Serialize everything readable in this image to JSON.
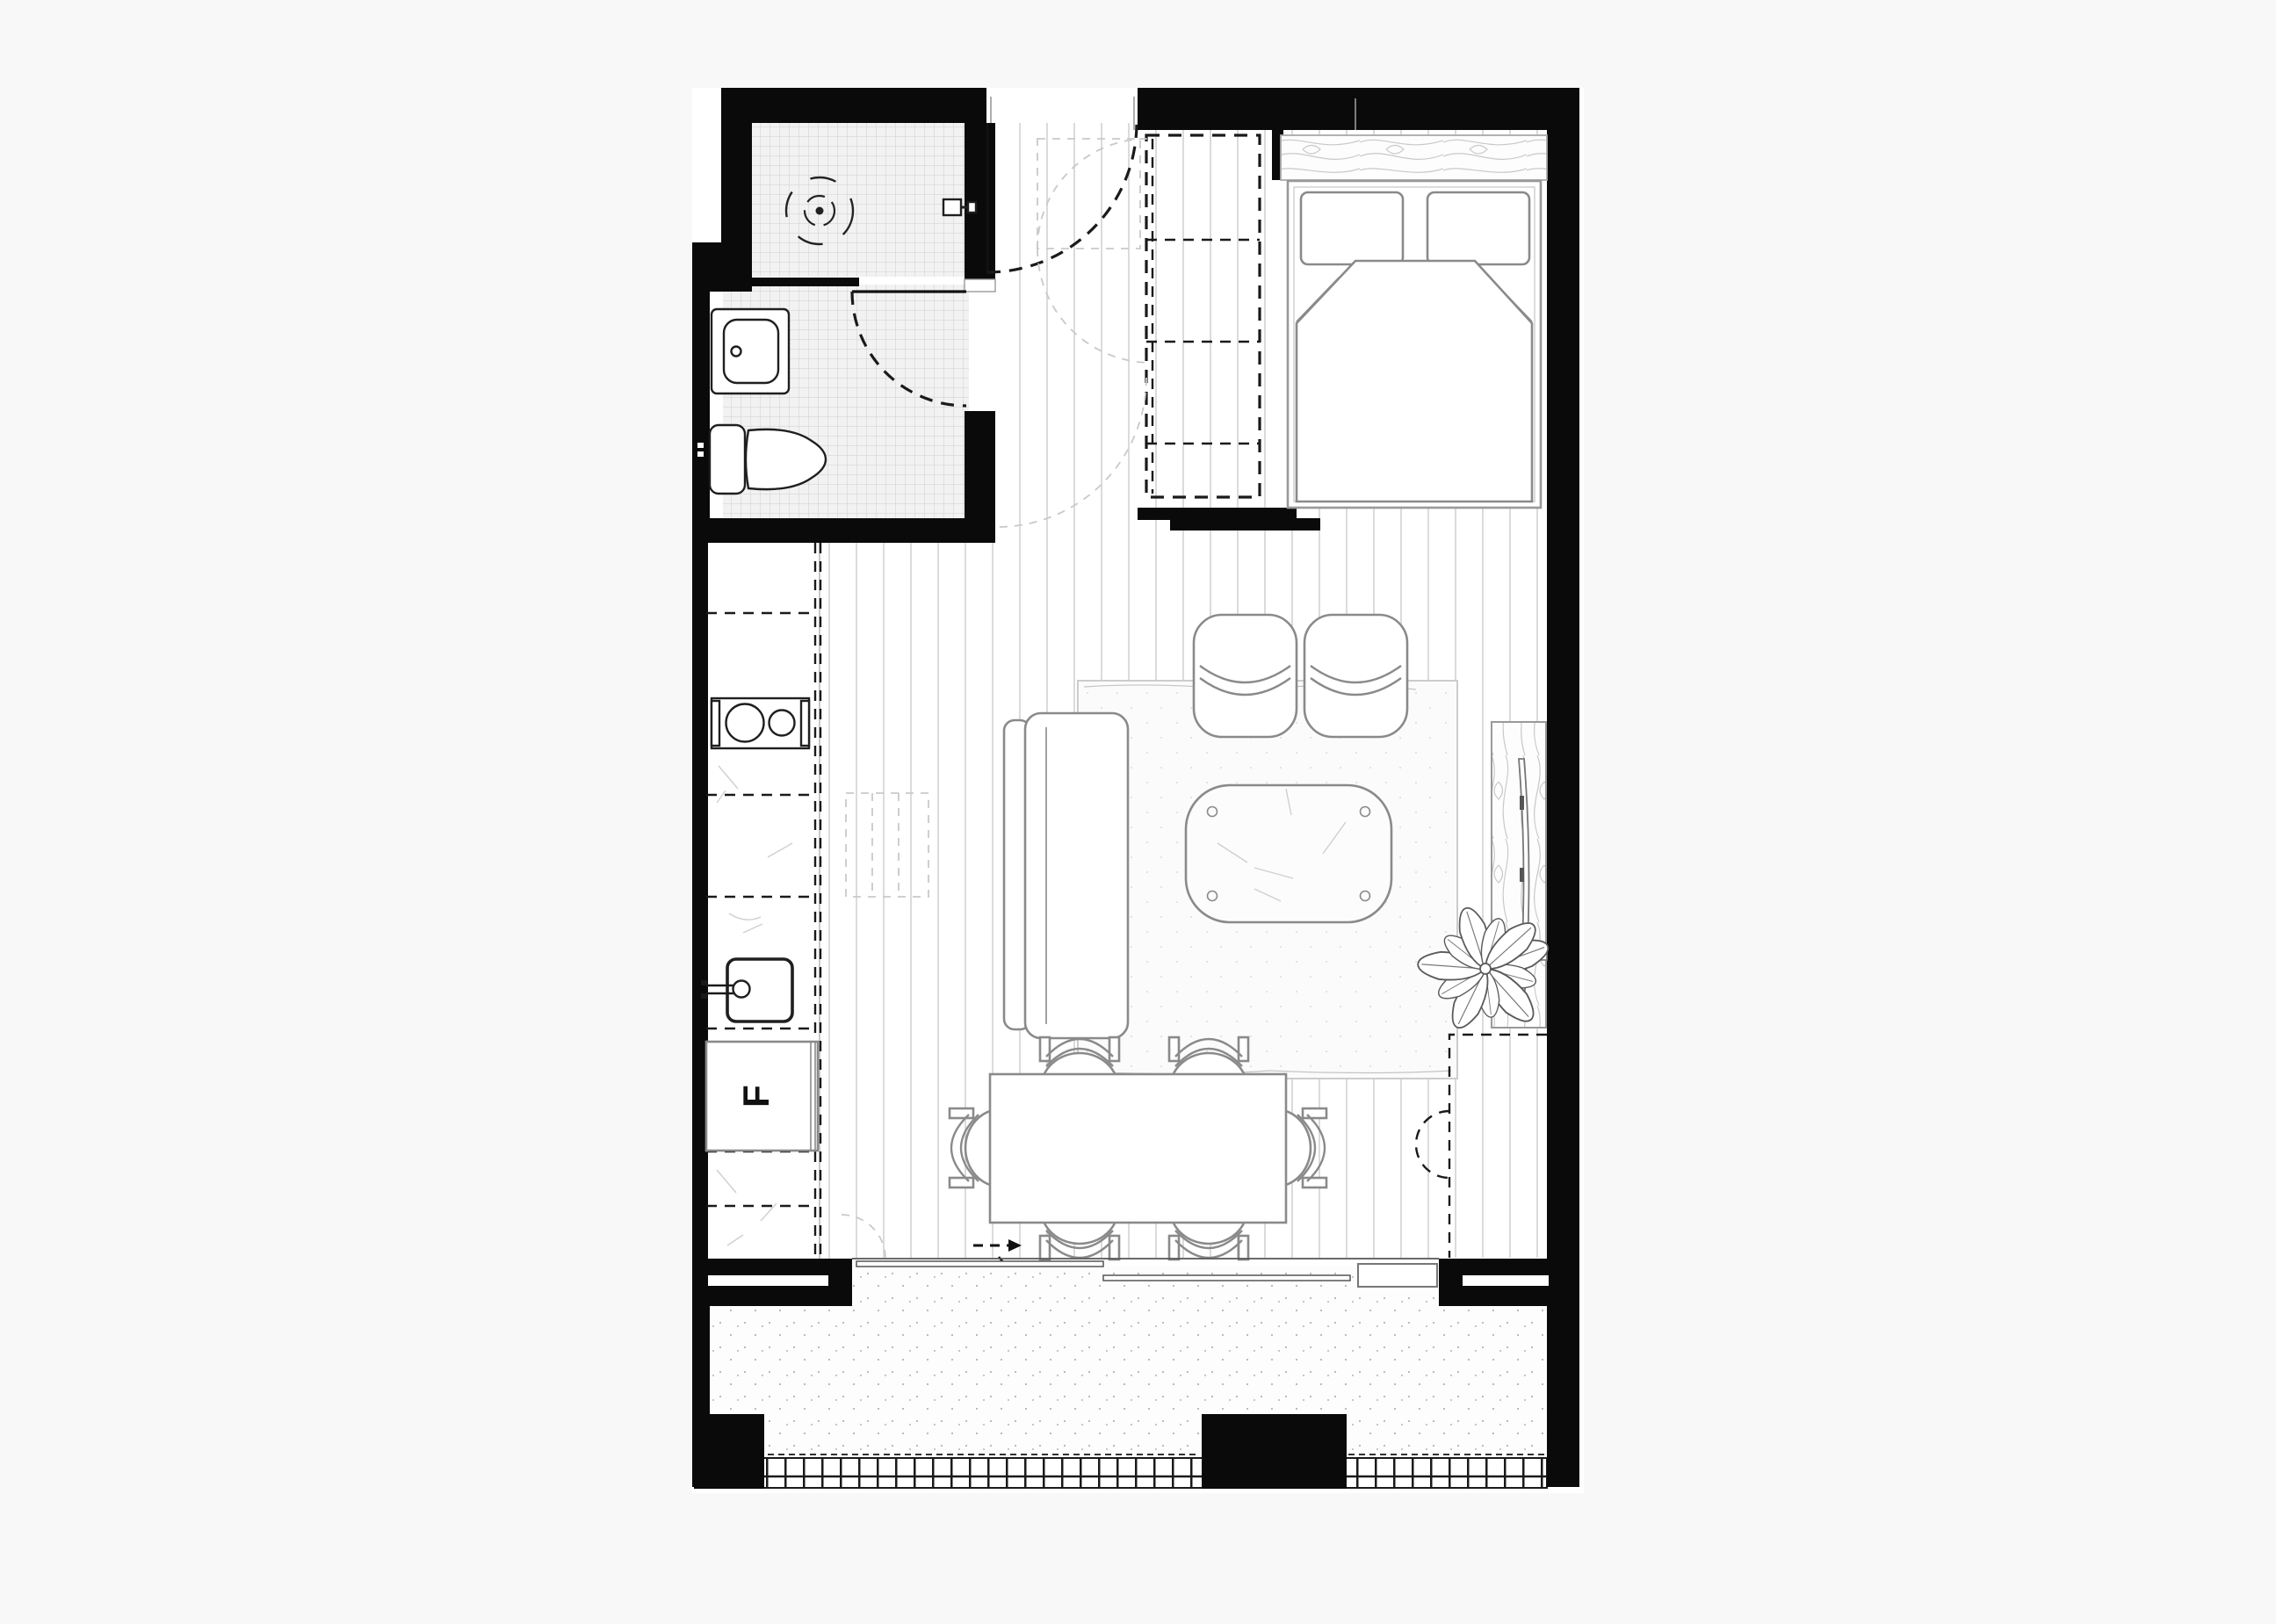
{
  "page": {
    "title": "Studio Apartment Floor Plan"
  },
  "labels": {
    "fridge": "F"
  },
  "colors": {
    "wall": "#0a0a0a",
    "line_strong": "#1f1f1f",
    "line_dark": "#1a1a1a",
    "line_mid": "#8a8a8a",
    "line_light": "#c9c9c9",
    "crack": "#cfcfcf",
    "plank_line": "#d2d2d2",
    "tile_bg": "#f2f2f2",
    "tile_line": "#cfcfcf",
    "stipple_dot": "#b5b5b5",
    "rug_bg": "#fbfbfb",
    "rug_dot": "#dcdcdc",
    "floor_bg": "#ffffff",
    "page_bg": "#f8f8f8",
    "grain": "#c9c9c9"
  },
  "plan": {
    "rooms": [
      {
        "id": "bathroom",
        "fixtures": [
          "shower",
          "shower drain",
          "shower mixer",
          "vanity sink",
          "toilet",
          "hinged door"
        ]
      },
      {
        "id": "entry",
        "features": [
          "entry door with swing arc",
          "dashed wardrobe / storage run",
          "overhead cabinet outlines"
        ]
      },
      {
        "id": "kitchen",
        "fixtures": [
          "counter run",
          "overhead cabinets (dashed)",
          "cooktop with two burners",
          "sink with mixer tap",
          "refrigerator"
        ]
      },
      {
        "id": "bedroom",
        "furniture": [
          "double bed",
          "two pillows",
          "duvet with folded corners",
          "timber headboard panel"
        ]
      },
      {
        "id": "living",
        "furniture": [
          "sofa",
          "armchair",
          "armchair",
          "coffee table",
          "rug",
          "timber tv unit",
          "wall-mounted tv",
          "plant"
        ]
      },
      {
        "id": "dining",
        "furniture": [
          "rectangular table",
          "six chairs"
        ],
        "features": [
          "entry direction arrow"
        ]
      },
      {
        "id": "balcony",
        "features": [
          "sliding glass doors",
          "masonry piers",
          "balustrade grate",
          "paved floor"
        ]
      }
    ]
  }
}
